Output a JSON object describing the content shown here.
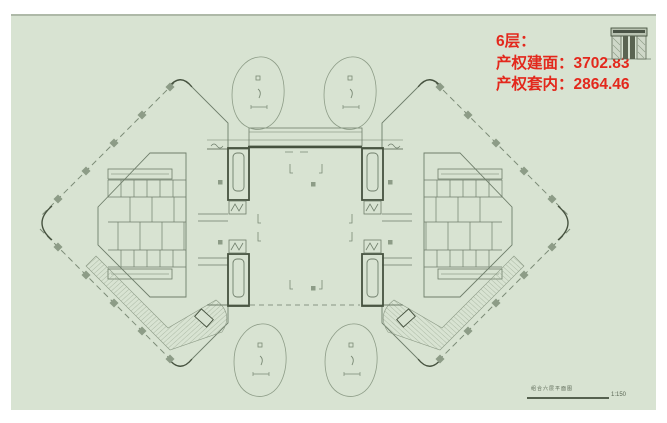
{
  "colors": {
    "canvas_background": "#d8e3d2",
    "page_margin": "#ffffff",
    "plan_linework": "#6f7e6b",
    "plan_dark_linework": "#46523f",
    "hatch": "#9aa994",
    "accent_red": "#e3281c"
  },
  "annotation": {
    "floor_label": "6层：",
    "gross_area_label": "产权建面：",
    "gross_area_value": "3702.83",
    "net_area_label": "产权套内：",
    "net_area_value": "2864.46"
  },
  "title_block": {
    "drawing_title": "组合六层平面图",
    "scale": "1:150"
  },
  "icon": {
    "detail_thumbnail": "door-section-detail-icon"
  }
}
